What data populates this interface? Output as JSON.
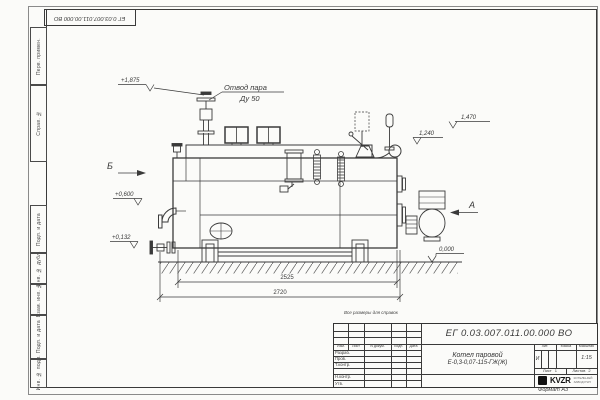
{
  "stamp_top": "ЕГ 0.03.007.011.00.000 ВО",
  "margin": {
    "perv": "Перв. примен.",
    "sprav": "Справ. №",
    "podp1": "Подп. и дата",
    "dubl": "Инв. № дубл.",
    "vzam": "Взам. инв. №",
    "podp2": "Подп. и дата",
    "podl": "Инв. № подл."
  },
  "ann": {
    "steam1": "Отвод пара",
    "steam2": "Ду 50",
    "e1875": "+1,875",
    "e1470": "1,470",
    "e1240": "1,240",
    "e0600": "+0,600",
    "e0132": "+0,132",
    "e0000": "0,000",
    "viewB": "Б",
    "viewA": "А",
    "d2525": "2525",
    "d2720": "2720",
    "note": "Все размеры для справок"
  },
  "tb": {
    "doc": "ЕГ 0.03.007.011.00.000  ВО",
    "name1": "Котел паровой",
    "name2": "Е-0,3-0,07-115-ГЖ(Ж)",
    "izm": "Изм.",
    "list": "Лист",
    "ndoc": "N докум.",
    "podp": "Подп.",
    "data": "Дата",
    "razrab": "Разраб.",
    "prov": "Пров.",
    "tkontr": "Т.контр.",
    "nkontr": "Н.контр.",
    "utv": "Утв.",
    "lit": "Лит.",
    "massa": "Масса",
    "scale_label": "Масштаб",
    "lit_val": "И",
    "scale": "1:15",
    "sheet_label": "Лист",
    "sheet_val": "1",
    "sheets_label": "Листов",
    "sheets_val": "2",
    "logo": "KVZR",
    "org1": "КОТЕЛЬНЫЙ",
    "org2": "ЗАВОД РЭП",
    "format": "Формат А3"
  }
}
